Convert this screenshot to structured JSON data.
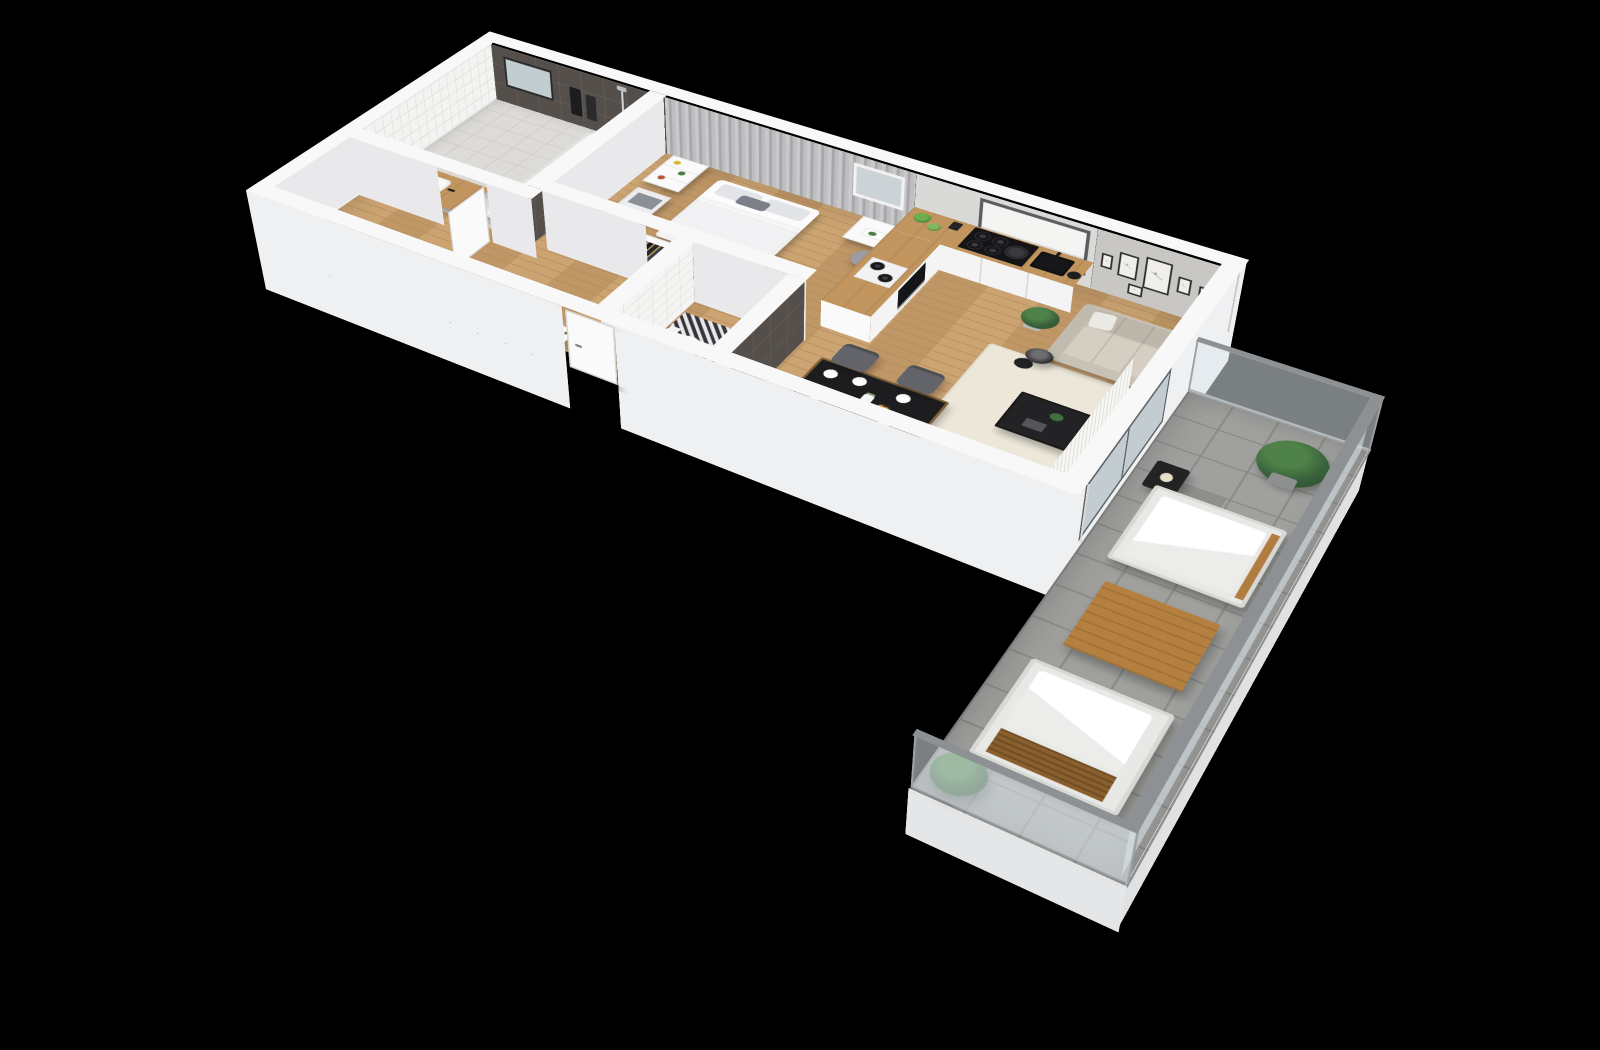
{
  "scene": {
    "title": "3D cutaway floor plan of a one-bedroom apartment with balcony",
    "style": "isometric cutaway render",
    "background_color": "#000000"
  },
  "palette": {
    "wall_top": "#f8f8f9",
    "wall_interior": "#e9e9ec",
    "wall_exterior": "#eef0f2",
    "sofa_wall_gray": "#c9c7c3",
    "dark_tile": "#554f4b",
    "white_tile": "#f3f3f1",
    "wood_floor": "#c99f6b",
    "wood_counter": "#c2955f",
    "balcony_tile": "#a0a09e",
    "rug": "#ece7d9",
    "sofa": "#c8c2b6",
    "chair_gray": "#63646a",
    "appliance_black": "#17171a",
    "plant_green": "#38603a",
    "glass": "#dfe8ec"
  },
  "rooms": [
    {
      "name": "bathroom",
      "furniture": [
        "bathtub",
        "washbasin on wood counter",
        "vanity cabinet",
        "mirror",
        "black towels",
        "shower set",
        "dark tiled walls",
        "white mosaic wall"
      ]
    },
    {
      "name": "hallway",
      "furniture": [
        "open clothes rack with hangers",
        "storage jars",
        "entry door",
        "bathroom door"
      ]
    },
    {
      "name": "bedroom",
      "furniture": [
        "double bed with gray pillows",
        "open wardrobe with dark clothes",
        "bookshelf",
        "drawer unit",
        "vanity desk",
        "wall mirror",
        "stool",
        "gray curtains"
      ]
    },
    {
      "name": "wc",
      "furniture": [
        "toilet",
        "patterned tile floor",
        "anthracite tiled wall",
        "white subway tiles"
      ]
    },
    {
      "name": "kitchen",
      "furniture": [
        "wood worktop",
        "4-burner black cooktop with pan",
        "oven",
        "black sink with faucet",
        "black kettle",
        "herb pots",
        "window with roller blind",
        "white cabinet fronts",
        "2-ring warmer"
      ]
    },
    {
      "name": "living-dining",
      "furniture": [
        "black dining table",
        "4 gray dining chairs",
        "plates and vase with flowers",
        "bowl of oranges",
        "beige 3-seat sofa",
        "white accent pillow",
        "cream rug",
        "black coffee table",
        "black floor lamp",
        "wall-mounted tv",
        "gallery of 6 frames",
        "2 potted plants",
        "white vertical blinds"
      ]
    },
    {
      "name": "balcony",
      "furniture": [
        "gray stone tiles",
        "glass balustrade",
        "2 white lounge chairs",
        "wooden coffee table",
        "black lantern",
        "2 potted plants"
      ]
    }
  ],
  "counts": {
    "dining_chairs": 4,
    "gallery_frames": 6,
    "lounge_chairs": 2,
    "hob_burners": 4,
    "balcony_plants": 2
  }
}
